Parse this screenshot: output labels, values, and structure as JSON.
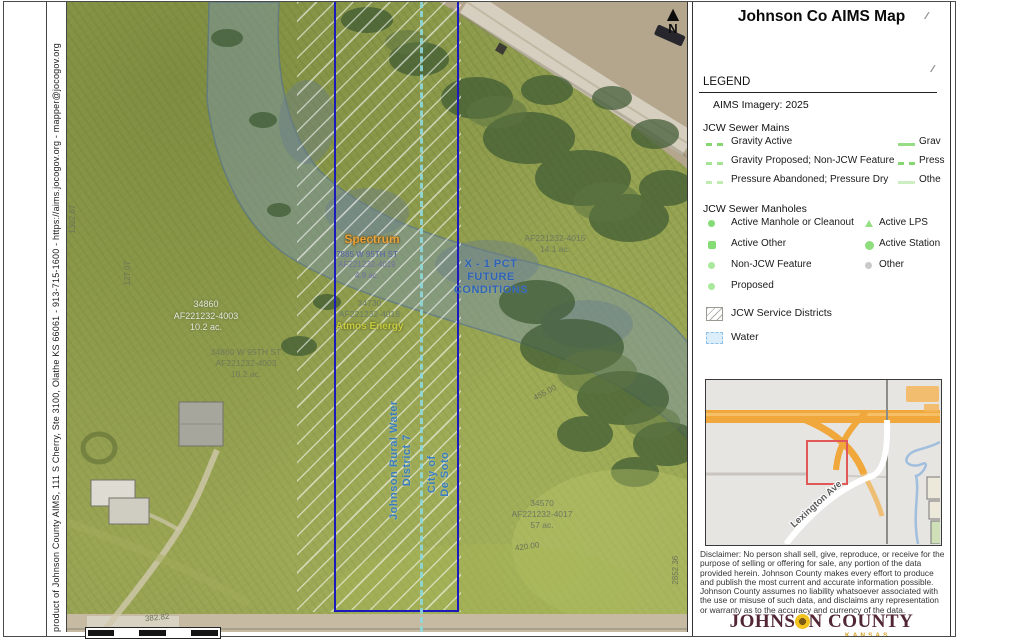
{
  "page": {
    "title": "Johnson Co AIMS Map"
  },
  "attribution": {
    "text": "product of Johnson County AIMS, 111 S Cherry, Ste 3100, Olathe KS  66061 - 913-715-1600 - https://aims.jocogov.org - mapper@jocogov.org"
  },
  "map": {
    "north": "N",
    "labels": {
      "spectrum": "Spectrum",
      "spectrum_addr": "7885 W 95TH ST",
      "spectrum_id": "AF221232-4019",
      "spectrum_area": "4.9 ac.",
      "atmos_parcel": "34730",
      "atmos_id": "AF221232-4018",
      "atmos_name": "Atmos Energy",
      "flood1": "X - 1 PCT",
      "flood2": "FUTURE",
      "flood3": "CONDITIONS",
      "parcel_a1": "34860",
      "parcel_a2": "AF221232-4003",
      "parcel_a3": "10.2 ac.",
      "parcel_b1": "34860 W 95TH ST",
      "parcel_b2": "AF221232-4003",
      "parcel_b3": "10.2 ac.",
      "parcel_c1": "AF221232-4015",
      "parcel_c2": "14.1 ac.",
      "parcel_d1": "34570",
      "parcel_d2": "AF221232-4017",
      "parcel_d3": "57 ac.",
      "jrwd1": "Johnson Rural Water",
      "jrwd2": "District 7",
      "desoto1": "City of",
      "desoto2": "De Soto",
      "dim_west": "1302.67",
      "dim_127": "127.07",
      "dim_455": "455.00",
      "dim_420": "420.00",
      "dim_2852": "2852.36",
      "dim_382": "382.82"
    }
  },
  "legend": {
    "heading": "LEGEND",
    "imagery": "AIMS Imagery: 2025",
    "handle": "∕∕",
    "sewer_mains": {
      "title": "JCW Sewer Mains",
      "col1": [
        "Gravity Active",
        "Gravity Proposed; Non-JCW Feature",
        "Pressure Abandoned; Pressure Dry"
      ],
      "col2": [
        "Grav",
        "Press",
        "Othe"
      ]
    },
    "manholes": {
      "title": "JCW Sewer Manholes",
      "col1": [
        "Active Manhole or Cleanout",
        "Active Other",
        "Non-JCW Feature",
        "Proposed"
      ],
      "col2": [
        "Active LPS",
        "Active Station",
        "Other"
      ]
    },
    "districts_label": "JCW Service Districts",
    "water_label": "Water"
  },
  "inset": {
    "road_label": "Lexington Ave"
  },
  "disclaimer": {
    "text": "Disclaimer: No person shall sell, give, reproduce, or receive for the purpose of selling or offering for sale, any portion of the data provided herein. Johnson County makes every effort to produce and publish the most current and accurate information possible. Johnson County assumes no liability whatsoever associated with the use or misuse of such data, and disclaims any representation or warranty as to the accuracy and currency of the data."
  },
  "logo": {
    "part1": "JOHNS",
    "part2": "N COUNTY",
    "sub": "KANSAS"
  },
  "colors": {
    "parcel_blue": "#1b1bbd",
    "sewer_cyan": "#8fd8dc",
    "legend_green": "#86d674",
    "other_gray": "#c9c9c9",
    "water_overlay": "#7a94a8",
    "flood_text_blue": "#2d62b5",
    "inset_highway_orange": "#f0a83c",
    "inset_extent_red": "#e05858",
    "logo_maroon": "#522635",
    "sunflower_gold": "#f2c21e",
    "imagery_green": "#93a050"
  }
}
